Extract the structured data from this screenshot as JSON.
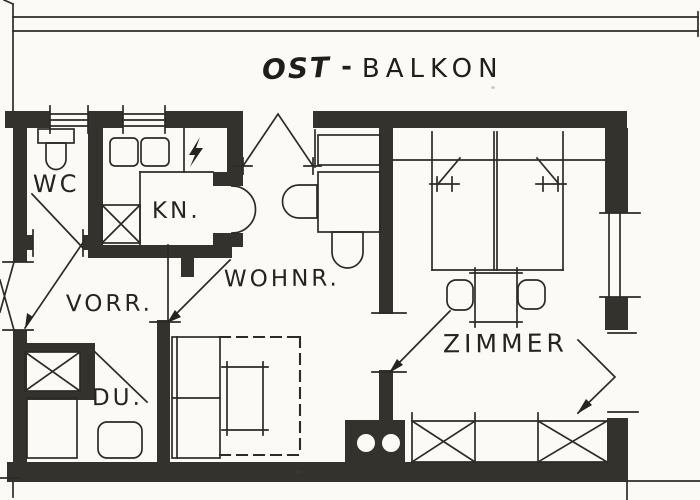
{
  "drawing": {
    "type": "apartment floor plan (scanned)",
    "title": {
      "orientation": "OST",
      "separator": "-",
      "balcony": "BALKON"
    },
    "rooms": {
      "wc": {
        "label": "WC"
      },
      "kitchen": {
        "label": "KN."
      },
      "hallway": {
        "label": "VORR."
      },
      "living_room": {
        "label": "WOHNR."
      },
      "shower": {
        "label": "DU."
      },
      "bedroom": {
        "label": "ZIMMER"
      }
    },
    "symbols": {
      "stove_power": "lightning-bolt",
      "wardrobe": "x-cross-box",
      "chimney": "block-with-two-flues"
    },
    "colors": {
      "paper": "#fbfaf6",
      "ink": "#2d2b27",
      "wall": "#34322d"
    }
  }
}
